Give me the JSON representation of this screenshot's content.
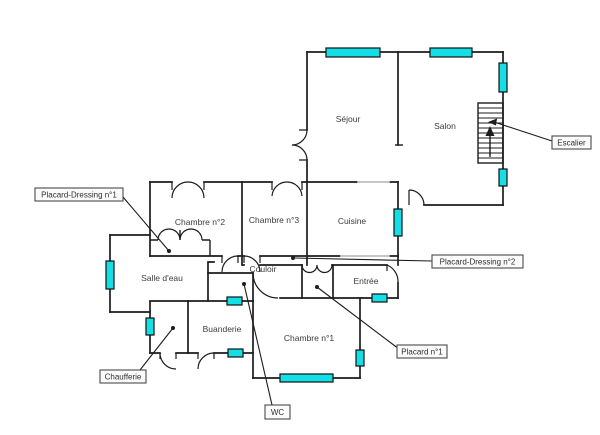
{
  "canvas": {
    "background": "#ffffff",
    "wall_color": "#1c1c1c",
    "window_marker_color": "#14dfe6",
    "opening_marker_color": "#b4b4b4"
  },
  "rooms": [
    {
      "id": "sejour",
      "name": "Séjour"
    },
    {
      "id": "salon",
      "name": "Salon"
    },
    {
      "id": "chambre-2",
      "name": "Chambre n°2"
    },
    {
      "id": "chambre-3",
      "name": "Chambre n°3"
    },
    {
      "id": "cuisine",
      "name": "Cuisine"
    },
    {
      "id": "salle-deau",
      "name": "Salle d'eau"
    },
    {
      "id": "couloir",
      "name": "Couloir"
    },
    {
      "id": "entree",
      "name": "Entrée"
    },
    {
      "id": "buanderie",
      "name": "Buanderie"
    },
    {
      "id": "chambre-1",
      "name": "Chambre n°1"
    }
  ],
  "callouts": [
    {
      "id": "placard-dressing-1",
      "label": "Placard-Dressing n°1"
    },
    {
      "id": "escalier",
      "label": "Escalier"
    },
    {
      "id": "placard-dressing-2",
      "label": "Placard-Dressing n°2"
    },
    {
      "id": "placard-1",
      "label": "Placard n°1"
    },
    {
      "id": "chaufferie",
      "label": "Chaufferie"
    },
    {
      "id": "wc",
      "label": "WC"
    }
  ],
  "stairs": {
    "symbol": "staircase",
    "direction": "up",
    "steps": 11
  }
}
